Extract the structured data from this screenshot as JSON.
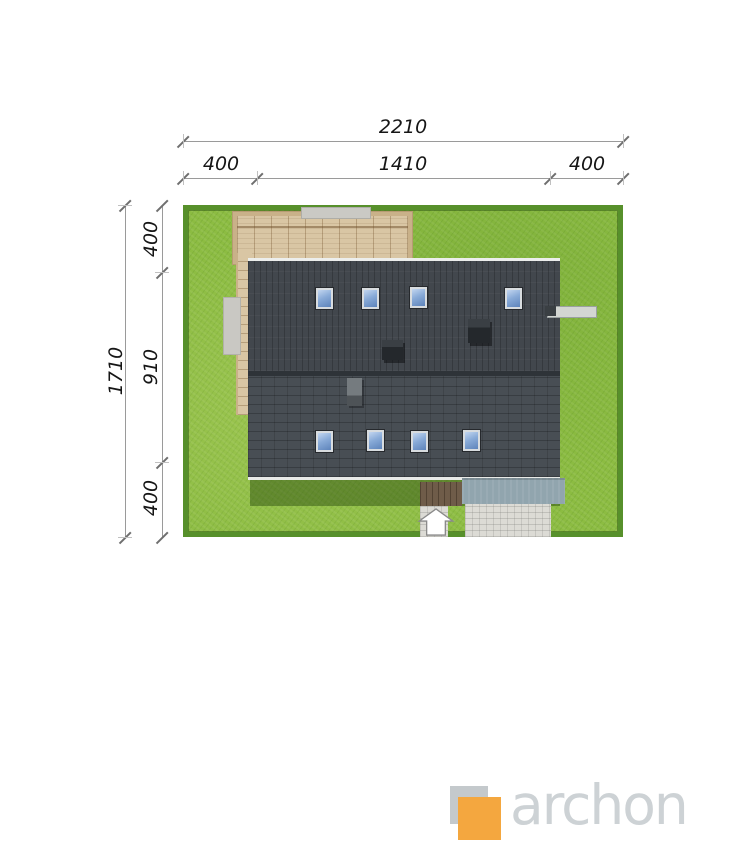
{
  "dimensions": {
    "top": {
      "overall": "2210",
      "segments": [
        "400",
        "1410",
        "400"
      ]
    },
    "left": {
      "overall": "1710",
      "segments": [
        "400",
        "910",
        "400"
      ]
    }
  },
  "site": {
    "lawn_color": "#8cbc42",
    "hedge_color": "#57902b",
    "roof_color": "#43484e",
    "roof_ridge_color": "#2e3338",
    "skylight_glass_color": "#89abd8",
    "pergola_wood_color": "#d9c6a4",
    "entrance_deck_color": "#6f5c49",
    "driveway_color": "#91a5ae",
    "paving_color": "#dcdbd5",
    "skylights_upper_count": 4,
    "skylights_lower_count": 4,
    "chimneys_count": 3
  },
  "icons": {
    "entrance_arrow": "house-shaped up arrow marking entrance"
  },
  "logo": {
    "text": "archon",
    "accent_color": "#f4a73f",
    "square_color": "#c4c9cc",
    "text_color": "#cdd2d5"
  }
}
